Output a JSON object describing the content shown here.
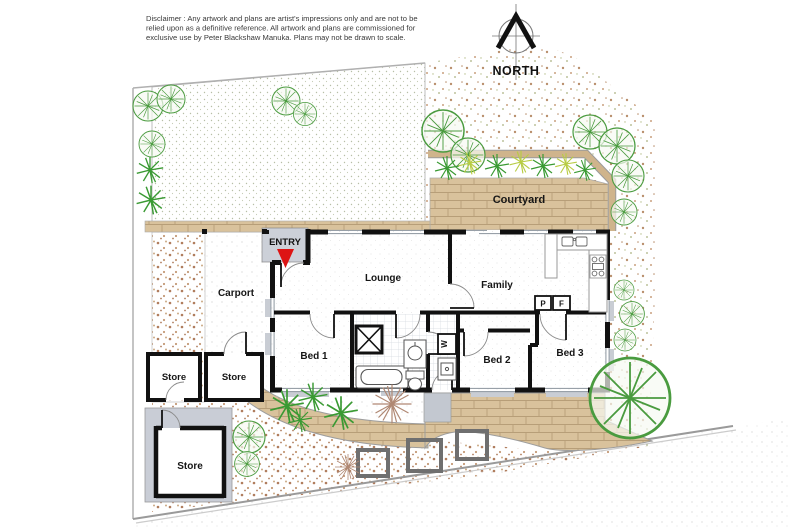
{
  "disclaimer": {
    "line1": "Disclaimer : Any artwork and plans are artist's impressions only and are not to be",
    "line2": "relied upon as a definitive reference. All artwork and plans are commissioned for",
    "line3": "exclusive use by Peter Blackshaw Manuka. Plans may not be drawn to scale."
  },
  "compass": {
    "label": "NORTH"
  },
  "rooms": {
    "lounge": "Lounge",
    "family": "Family",
    "bed1": "Bed 1",
    "bed2": "Bed 2",
    "bed3": "Bed 3"
  },
  "outdoor": {
    "courtyard": "Courtyard",
    "carport": "Carport",
    "entry": "ENTRY",
    "store_left": "Store",
    "store_right": "Store",
    "store_detached": "Store"
  },
  "appliances": {
    "pantry": "P",
    "fridge": "F",
    "washer": "W"
  },
  "colors": {
    "paving": "#d9c29c",
    "paving_edge": "#cfb48c",
    "wall": "#111111",
    "porch_gray": "#ccd0d8",
    "entry_arrow": "#dd1414",
    "tree_green": "#4a9b3f",
    "shrub_green": "#3a9a33",
    "shrub_yellow": "#b8cc44",
    "plant_brown": "#b08873",
    "dirt_dot": "#b98f6d",
    "lawn_dot": "#b7bfa6"
  }
}
